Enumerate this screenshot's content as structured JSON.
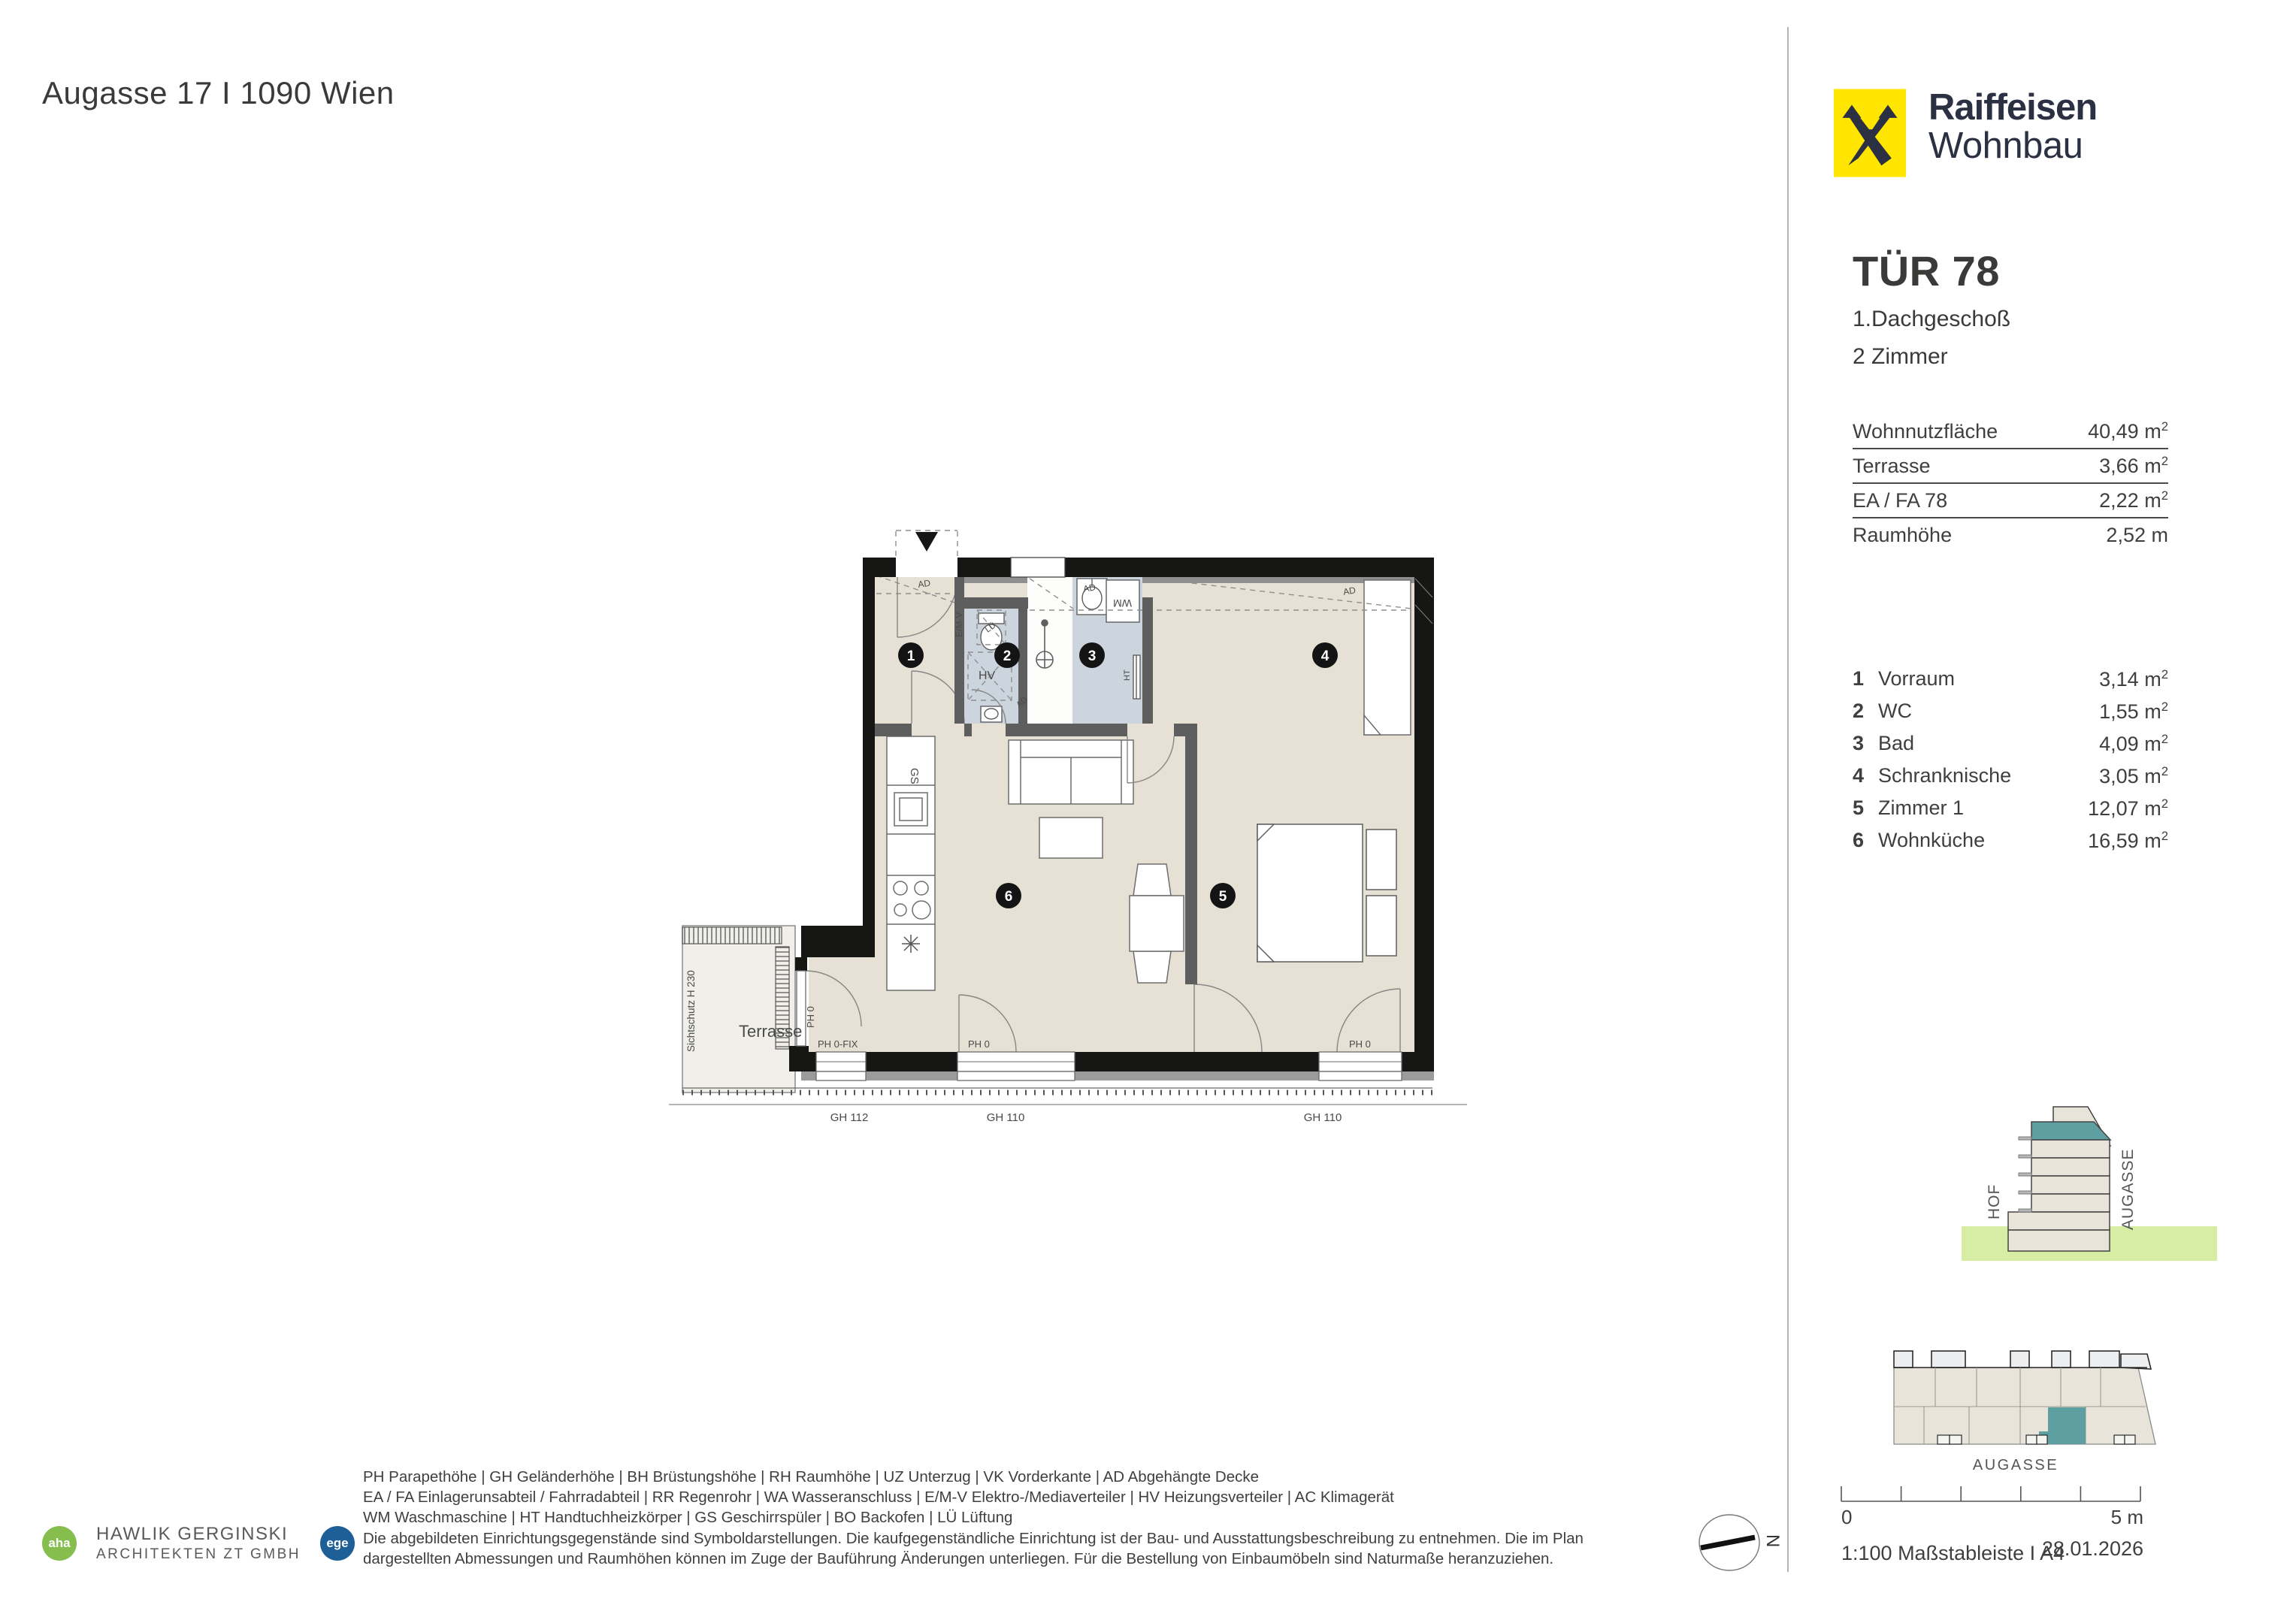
{
  "page": {
    "title": "Augasse 17 I 1090 Wien"
  },
  "brand": {
    "line1": "Raiffeisen",
    "line2": "Wohnbau",
    "logo_yellow": "#FFE500",
    "logo_dark": "#2B3143"
  },
  "unit": {
    "door": "TÜR 78",
    "floor": "1.Dachgeschoß",
    "rooms": "2 Zimmer"
  },
  "summary": {
    "rows": [
      {
        "label": "Wohnnutzfläche",
        "value": "40,49",
        "unit": "m",
        "sup": "2"
      },
      {
        "label": "Terrasse",
        "value": "3,66",
        "unit": "m",
        "sup": "2"
      },
      {
        "label": "EA / FA 78",
        "value": "2,22",
        "unit": "m",
        "sup": "2"
      },
      {
        "label": "Raumhöhe",
        "value": "2,52",
        "unit": "m",
        "sup": ""
      }
    ]
  },
  "room_list": {
    "rows": [
      {
        "num": "1",
        "label": "Vorraum",
        "value": "3,14",
        "unit": "m",
        "sup": "2"
      },
      {
        "num": "2",
        "label": "WC",
        "value": "1,55",
        "unit": "m",
        "sup": "2"
      },
      {
        "num": "3",
        "label": "Bad",
        "value": "4,09",
        "unit": "m",
        "sup": "2"
      },
      {
        "num": "4",
        "label": "Schranknische",
        "value": "3,05",
        "unit": "m",
        "sup": "2"
      },
      {
        "num": "5",
        "label": "Zimmer 1",
        "value": "12,07",
        "unit": "m",
        "sup": "2"
      },
      {
        "num": "6",
        "label": "Wohnküche",
        "value": "16,59",
        "unit": "m",
        "sup": "2"
      }
    ]
  },
  "plan": {
    "room_numbers": [
      "1",
      "2",
      "3",
      "4",
      "5",
      "6"
    ],
    "labels": {
      "ad": "AD",
      "emv": "E/M-V",
      "lue": "LÜ",
      "hv": "HV",
      "wm": "WM",
      "ht": "HT",
      "gs": "GS",
      "terrasse": "Terrasse",
      "sichtschutz": "Sichtschutz H 230",
      "ph0": "PH 0",
      "ph0fix": "PH 0-FIX",
      "gh112": "GH 112",
      "gh110": "GH 110"
    },
    "floor_color": "#e7e1d5",
    "wet_room_color": "#ccd4de"
  },
  "section_diagram": {
    "hof": "HOF",
    "augasse": "AUGASSE",
    "highlight_color": "#5E9FA1",
    "ground_color": "#D8EDA4"
  },
  "site_plan": {
    "street": "AUGASSE",
    "highlight_color": "#5E9FA1"
  },
  "scale_bar": {
    "start": "0",
    "end": "5 m"
  },
  "footer": {
    "scale_note": "1:100 Maßstableiste I A4",
    "date": "28.01.2026",
    "compass": "N"
  },
  "architects": {
    "badge1": "aha",
    "name_line1": "HAWLIK GERGINSKI",
    "name_line2": "ARCHITEKTEN ZT GMBH",
    "badge2": "ege",
    "badge1_color": "#85BE4C",
    "badge2_color": "#1D5F96"
  },
  "legend": {
    "lines": [
      "PH Parapethöhe | GH Geländerhöhe | BH Brüstungshöhe  |  RH Raumhöhe | UZ Unterzug | VK Vorderkante | AD Abgehängte Decke",
      "EA / FA Einlagerunsabteil / Fahrradabteil | RR Regenrohr | WA Wasseranschluss | E/M-V Elektro-/Mediaverteiler | HV Heizungsverteiler | AC Klimagerät",
      "WM Waschmaschine | HT Handtuchheizkörper | GS Geschirrspüler | BO Backofen | LÜ Lüftung",
      "Die abgebildeten Einrichtungsgegenstände sind Symboldarstellungen. Die kaufgegenständliche Einrichtung ist der Bau- und Ausstattungsbeschreibung zu entnehmen. Die im Plan",
      "dargestellten Abmessungen und Raumhöhen können im Zuge der Bauführung Änderungen unterliegen. Für die Bestellung von Einbaumöbeln sind Naturmaße heranzuziehen."
    ]
  }
}
